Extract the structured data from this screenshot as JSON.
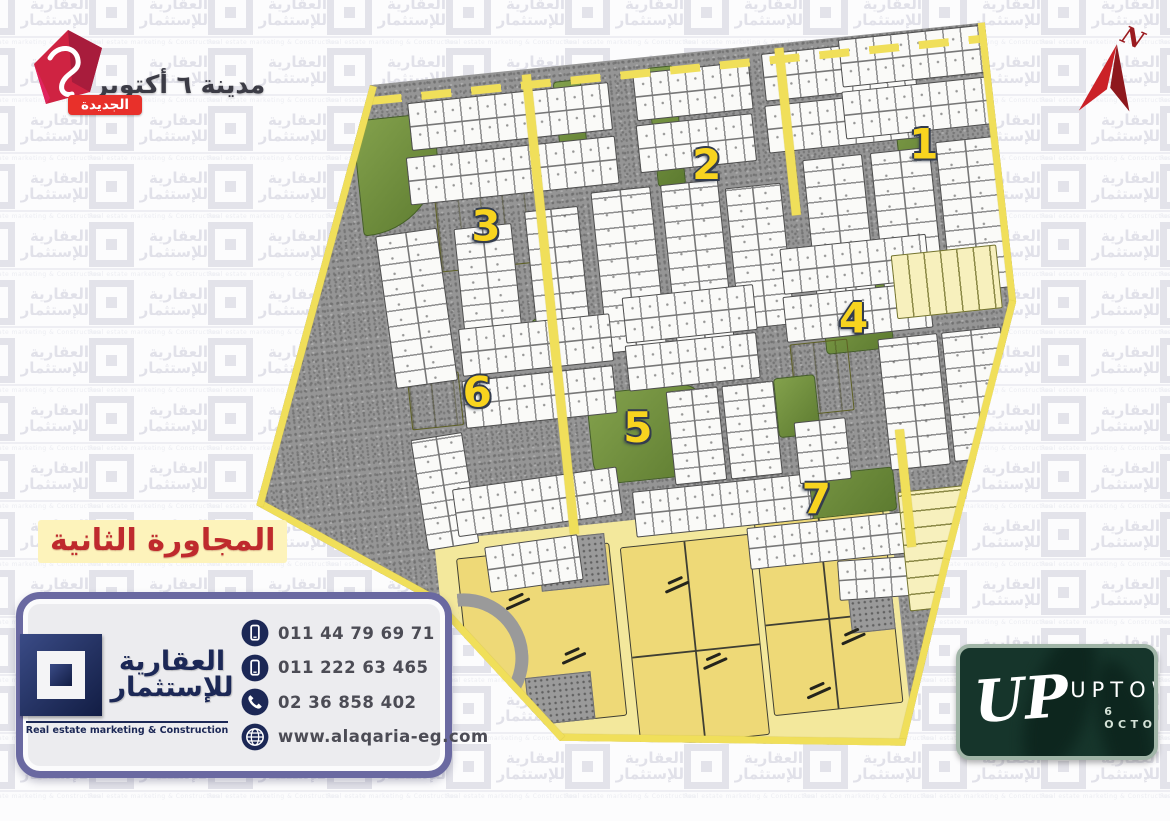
{
  "header_logo": {
    "city_name": "مدينة ٦ أكتوبر",
    "badge": "الجديدة"
  },
  "compass": {
    "label": "N"
  },
  "neighbourhood_title": {
    "text": "المجاورة الثانية"
  },
  "map": {
    "districts": [
      {
        "label": "1"
      },
      {
        "label": "2"
      },
      {
        "label": "3"
      },
      {
        "label": "4"
      },
      {
        "label": "5"
      },
      {
        "label": "6"
      },
      {
        "label": "7"
      }
    ]
  },
  "contact_card": {
    "brand_ar_line1": "العقارية",
    "brand_ar_line2": "للإستثمار",
    "brand_en": "Real estate marketing & Construction",
    "items": [
      {
        "icon": "mobile-icon",
        "value": "011 44 79 69 71"
      },
      {
        "icon": "mobile-icon",
        "value": "011 222 63 465"
      },
      {
        "icon": "phone-icon",
        "value": "02 36 858 402"
      },
      {
        "icon": "globe-icon",
        "value": "www.alaqaria-eg.com"
      }
    ]
  },
  "uptown_logo": {
    "monogram": "UP",
    "name": "UPTOWN",
    "sub": "6 OCTOBER"
  },
  "watermark": {
    "line1": "العقارية",
    "line2": "للإستثمار",
    "line3": "Real estate marketing & Construction"
  },
  "colors": {
    "road_yellow": "#f0df5a",
    "ground_gray": "#959595",
    "district_number_yellow": "#f8d41f",
    "brand_navy": "#1c2856",
    "card_border_purple": "#6a69a1",
    "title_red": "#bf2a2d",
    "uptown_green": "#16352b",
    "logo_red": "#cf2342"
  }
}
